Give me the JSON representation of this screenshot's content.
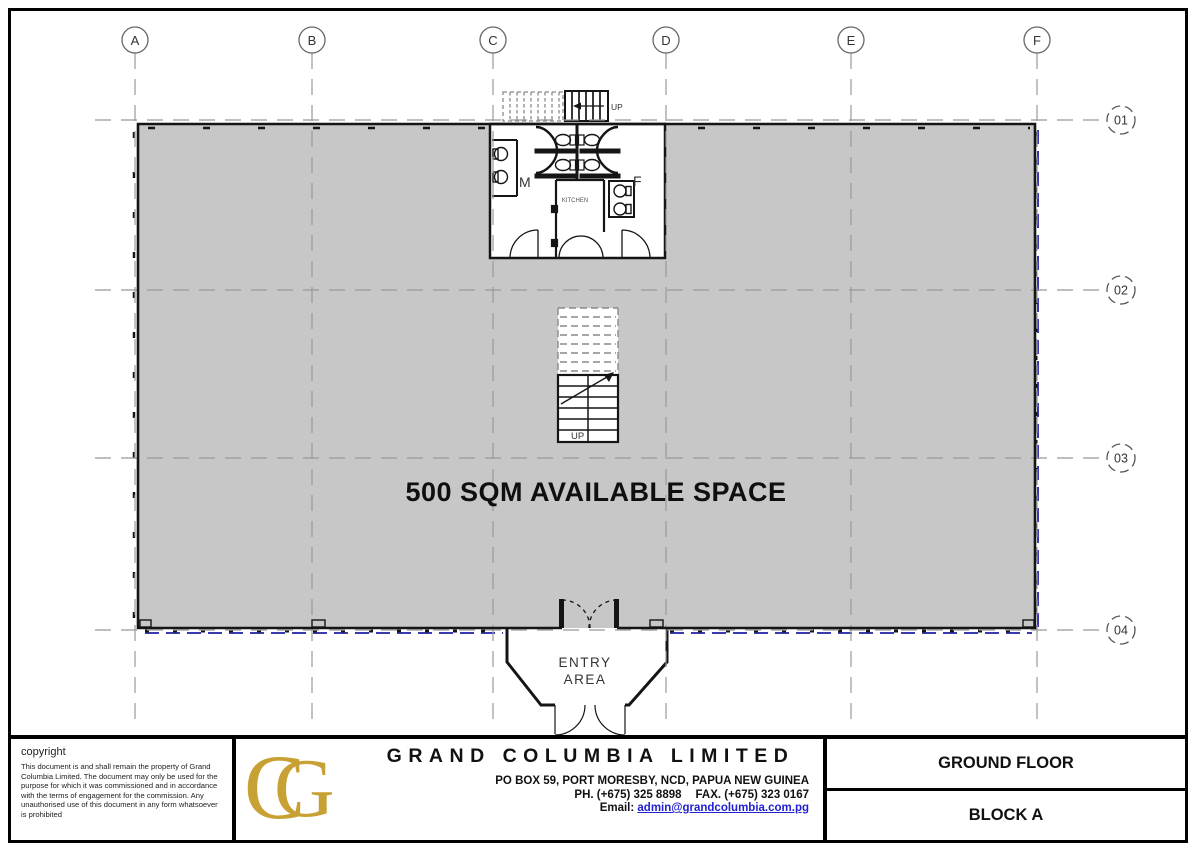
{
  "plan": {
    "available_space_label": "500 SQM AVAILABLE SPACE",
    "entry_line1": "ENTRY",
    "entry_line2": "AREA",
    "male_label": "M",
    "female_label": "F",
    "kitchen_label": "KITCHEN",
    "stair_up_label": "UP",
    "external_stair_up_label": "UP",
    "grid_columns": [
      "A",
      "B",
      "C",
      "D",
      "E",
      "F"
    ],
    "grid_rows": [
      "01",
      "02",
      "03",
      "04"
    ]
  },
  "title_block": {
    "copyright_heading": "copyright",
    "copyright_body": "This document is and shall remain the property of Grand Columbia Limited. The document may only be used for the purpose for which it was commissioned and in accordance with the terms of engagement for the commission. Any unauthorised use of this document in any form whatsoever is prohibited",
    "logo_letter_c": "C",
    "logo_letter_g": "G",
    "company_name": "GRAND COLUMBIA LIMITED",
    "address": "PO BOX 59, PORT MORESBY, NCD, PAPUA NEW GUINEA",
    "phone": "PH. (+675) 325 8898",
    "fax": "FAX. (+675) 323 0167",
    "email_label": "Email:",
    "email": "admin@grandcolumbia.com.pg",
    "drawing_title": "GROUND FLOOR",
    "block_label": "BLOCK A"
  },
  "colors": {
    "floor_fill_gray": "#c7c7c7",
    "wall_black": "#151515",
    "glazing_blue": "#3b3bb0",
    "grid_gray": "#999999",
    "logo_gold": "#c7a133",
    "email_link_blue": "#2121d1"
  }
}
